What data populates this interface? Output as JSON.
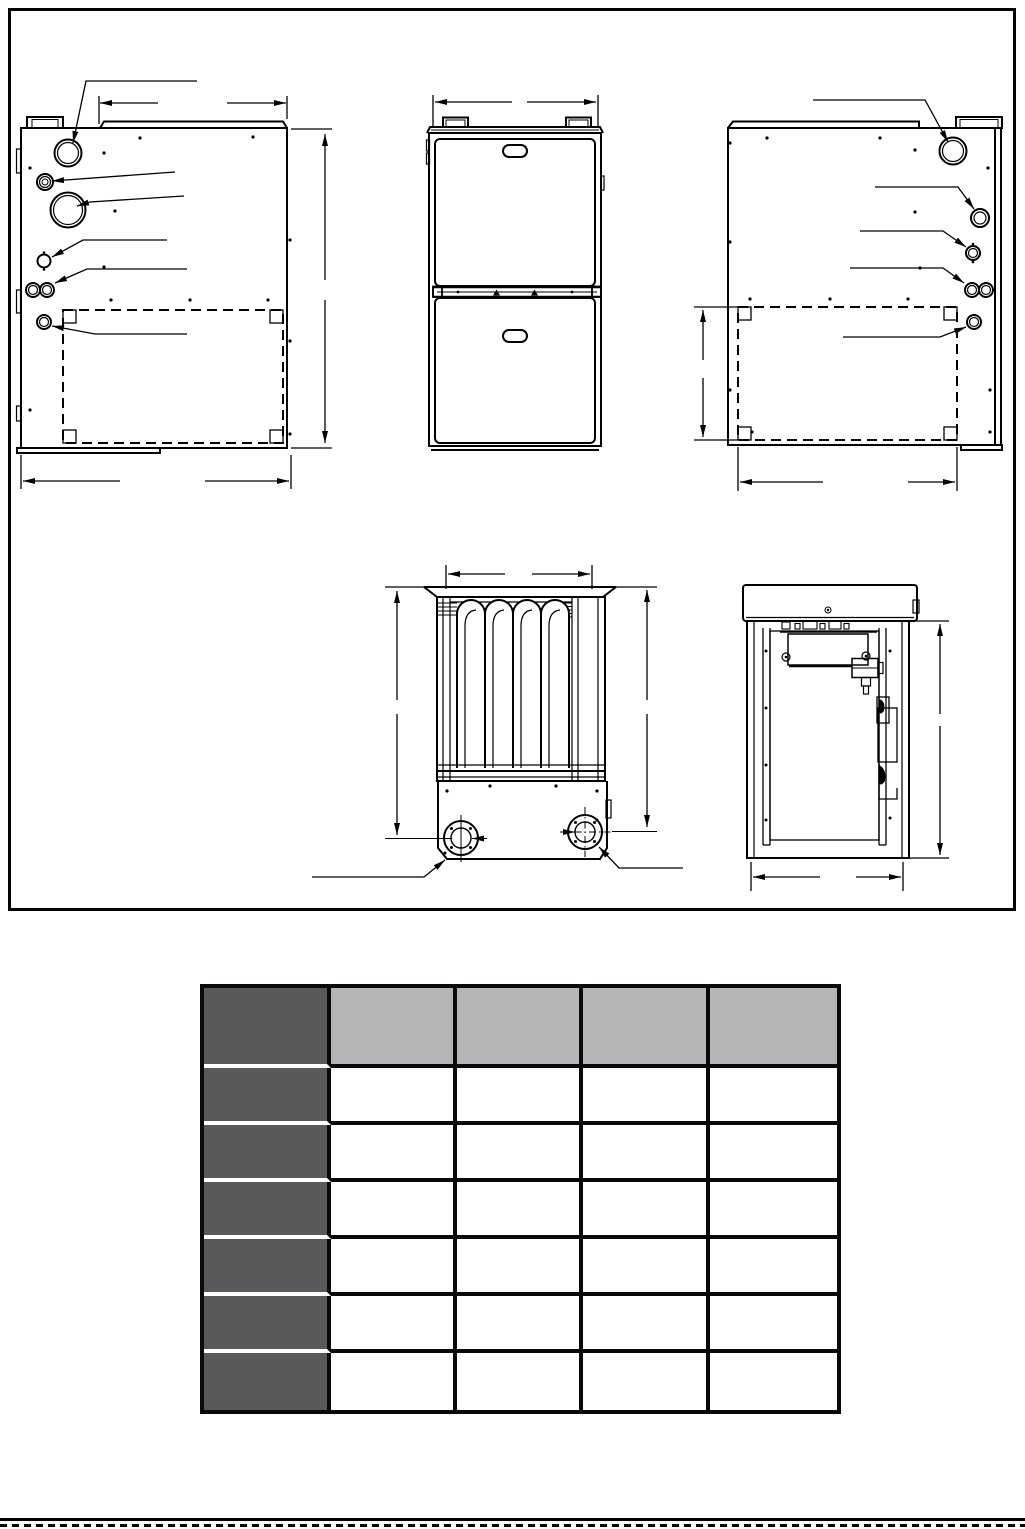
{
  "theme": {
    "page-bg": "#ffffff",
    "line": "#000000",
    "table-dark": "#58595b",
    "table-light": "#b4b5b7",
    "table-grid": "#0a0a0a",
    "row-sep": "#ffffff"
  },
  "table": {
    "columns": [
      "",
      "",
      "",
      "",
      ""
    ],
    "rows": [
      [
        "",
        "",
        "",
        "",
        ""
      ],
      [
        "",
        "",
        "",
        "",
        ""
      ],
      [
        "",
        "",
        "",
        "",
        ""
      ],
      [
        "",
        "",
        "",
        "",
        ""
      ],
      [
        "",
        "",
        "",
        "",
        ""
      ],
      [
        "",
        "",
        "",
        "",
        ""
      ]
    ]
  }
}
